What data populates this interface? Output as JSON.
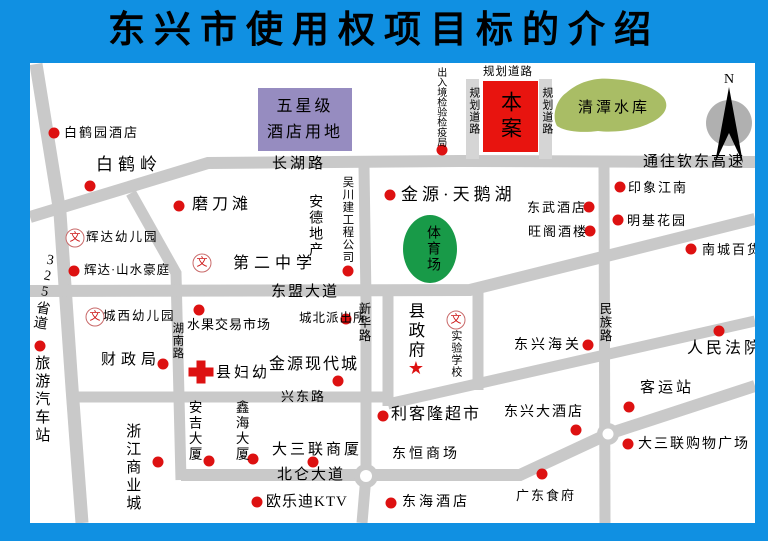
{
  "title": "东兴市使用权项目标的介绍",
  "map": {
    "colors": {
      "background": "#1090e2",
      "road": "#c9c9c9",
      "planned_road": "#d5d5d5",
      "marker": "#dd1111",
      "site_box": "#e8140f",
      "hotel_land_box": "#968cc0",
      "reservoir": "#a9bd65",
      "stadium": "#189a48",
      "compass_gray": "#b0b0b0"
    },
    "icons": {
      "school": "文",
      "star": "★"
    },
    "compass": {
      "label": "N"
    },
    "areas": {
      "hotel_land": {
        "line1": "五星级",
        "line2": "酒店用地"
      },
      "ben_an": {
        "text": "本案"
      },
      "reservoir": {
        "text": "清潭水库"
      },
      "stadium": {
        "text": "体育场"
      }
    },
    "labels": [
      {
        "name": "baiheyuan-hotel",
        "text": "白鹤园酒店",
        "type": "h",
        "x": 64,
        "y": 126,
        "size": 13,
        "ls": 2,
        "dot": [
          54,
          133
        ]
      },
      {
        "name": "baiheling",
        "text": "白鹤岭",
        "type": "h",
        "x": 96,
        "y": 156,
        "size": 17,
        "ls": 5,
        "dot": [
          90,
          186
        ]
      },
      {
        "name": "modaotan",
        "text": "磨刀滩",
        "type": "h",
        "x": 192,
        "y": 196,
        "size": 16,
        "ls": 4,
        "dot": [
          179,
          206
        ]
      },
      {
        "name": "huida-kindergarten",
        "text": "辉达幼儿园",
        "type": "h",
        "x": 86,
        "y": 231,
        "size": 12.5,
        "ls": 2,
        "wen": [
          75,
          238
        ]
      },
      {
        "name": "huida-shanshui-mansion",
        "text": "辉达·山水豪庭",
        "type": "h",
        "x": 84,
        "y": 264,
        "size": 12.5,
        "ls": 1,
        "dot": [
          74,
          271
        ]
      },
      {
        "name": "chengxi-kindergarten",
        "text": "城西幼儿园",
        "type": "h",
        "x": 103,
        "y": 310,
        "size": 12.5,
        "ls": 2,
        "wen": [
          95,
          317
        ]
      },
      {
        "name": "finance-bureau",
        "text": "财政局",
        "type": "h",
        "x": 101,
        "y": 352,
        "size": 15,
        "ls": 5,
        "dot": [
          163,
          364
        ]
      },
      {
        "name": "tourist-bus-station",
        "text": "旅游汽车站",
        "type": "v",
        "x": 33,
        "y": 355,
        "size": 15,
        "ls": 3,
        "dot": [
          40,
          346
        ]
      },
      {
        "name": "provincial-road-325",
        "text": "325省道",
        "type": "v",
        "x": 44,
        "y": 252,
        "size": 14,
        "ls": 1,
        "rot": 10
      },
      {
        "name": "zhejiang-commercial-city",
        "text": "浙江商业城",
        "type": "v",
        "x": 124,
        "y": 423,
        "size": 15,
        "ls": 3,
        "dot": [
          158,
          462
        ]
      },
      {
        "name": "changhu-road",
        "text": "长湖路",
        "type": "h",
        "x": 272,
        "y": 156,
        "size": 15,
        "ls": 3
      },
      {
        "name": "ande-property",
        "text": "安德地产",
        "type": "v",
        "x": 307,
        "y": 194,
        "size": 14,
        "ls": 2
      },
      {
        "name": "wuchuan-construction-co",
        "text": "吴川建工程公司",
        "type": "v",
        "x": 341,
        "y": 176,
        "size": 11.5,
        "ls": 1,
        "dot": [
          348,
          271
        ]
      },
      {
        "name": "no2-middle-school",
        "text": "第二中学",
        "type": "h",
        "x": 233,
        "y": 255,
        "size": 16,
        "ls": 5,
        "wen": [
          202,
          263
        ]
      },
      {
        "name": "dongmeng-avenue",
        "text": "东盟大道",
        "type": "h",
        "x": 271,
        "y": 284,
        "size": 15,
        "ls": 2
      },
      {
        "name": "hunan-road",
        "text": "湖南路",
        "type": "v",
        "x": 171,
        "y": 322,
        "size": 11.5,
        "ls": 1
      },
      {
        "name": "fruit-trading-market",
        "text": "水果交易市场",
        "type": "h",
        "x": 187,
        "y": 318,
        "size": 13,
        "ls": 1,
        "dot": [
          199,
          310
        ]
      },
      {
        "name": "county-maternity-hospital",
        "text": "县妇幼",
        "type": "h",
        "x": 216,
        "y": 365,
        "size": 15,
        "ls": 3,
        "cross": [
          201,
          372
        ]
      },
      {
        "name": "chengbei-police-station",
        "text": "城北派出所",
        "type": "h",
        "x": 299,
        "y": 312,
        "size": 12.5,
        "ls": 1,
        "dot": [
          346,
          319
        ]
      },
      {
        "name": "jinyuan-modern-city",
        "text": "金源现代城",
        "type": "h",
        "x": 269,
        "y": 356,
        "size": 16,
        "ls": 2,
        "dot": [
          338,
          381
        ]
      },
      {
        "name": "xinhua-road",
        "text": "新华路",
        "type": "v",
        "x": 356,
        "y": 302,
        "size": 12.5,
        "ls": 1
      },
      {
        "name": "xingdong-road",
        "text": "兴东路",
        "type": "h",
        "x": 281,
        "y": 390,
        "size": 13,
        "ls": 2
      },
      {
        "name": "anji-building",
        "text": "安吉大厦",
        "type": "v",
        "x": 186,
        "y": 400,
        "size": 13.5,
        "ls": 2,
        "dot": [
          209,
          461
        ]
      },
      {
        "name": "xinhai-building",
        "text": "鑫海大厦",
        "type": "v",
        "x": 233,
        "y": 400,
        "size": 13.5,
        "ls": 2,
        "dot": [
          253,
          459
        ]
      },
      {
        "name": "dasanlian-building",
        "text": "大三联商厦",
        "type": "h",
        "x": 272,
        "y": 442,
        "size": 15,
        "ls": 3,
        "dot": [
          313,
          462
        ]
      },
      {
        "name": "beilun-avenue",
        "text": "北仑大道",
        "type": "h",
        "x": 277,
        "y": 467,
        "size": 15,
        "ls": 2
      },
      {
        "name": "oulodi-ktv",
        "text": "欧乐迪KTV",
        "type": "h",
        "x": 266,
        "y": 494,
        "size": 15,
        "ls": 1,
        "dot": [
          257,
          502
        ]
      },
      {
        "name": "entry-exit-inspection-bureau",
        "text": "出入境检验检疫局",
        "type": "v",
        "x": 434,
        "y": 67,
        "size": 10,
        "ls": 0,
        "dot": [
          442,
          150
        ]
      },
      {
        "name": "planned-road-top",
        "text": "规划道路",
        "type": "h",
        "x": 483,
        "y": 66,
        "size": 11.5,
        "ls": 1
      },
      {
        "name": "planned-road-left",
        "text": "规划道路",
        "type": "v",
        "x": 467,
        "y": 87,
        "size": 11,
        "ls": 1
      },
      {
        "name": "planned-road-right",
        "text": "规划道路",
        "type": "v",
        "x": 540,
        "y": 87,
        "size": 11,
        "ls": 1
      },
      {
        "name": "to-qindong-expressway",
        "text": "通往钦东高速",
        "type": "h",
        "x": 643,
        "y": 154,
        "size": 15,
        "ls": 2
      },
      {
        "name": "jinyuan-swan-lake",
        "text": "金源·天鹅湖",
        "type": "h",
        "x": 401,
        "y": 186,
        "size": 17,
        "ls": 4,
        "dot": [
          390,
          195
        ]
      },
      {
        "name": "dongwu-hotel",
        "text": "东武酒店",
        "type": "h",
        "x": 527,
        "y": 201,
        "size": 13,
        "ls": 2,
        "dot": [
          589,
          207
        ]
      },
      {
        "name": "wangge-restaurant",
        "text": "旺阁酒楼",
        "type": "h",
        "x": 528,
        "y": 225,
        "size": 13,
        "ls": 2,
        "dot": [
          590,
          231
        ]
      },
      {
        "name": "yinxiang-jiangnan",
        "text": "印象江南",
        "type": "h",
        "x": 628,
        "y": 181,
        "size": 13,
        "ls": 2,
        "dot": [
          620,
          187
        ]
      },
      {
        "name": "mingji-garden",
        "text": "明基花园",
        "type": "h",
        "x": 627,
        "y": 214,
        "size": 13,
        "ls": 2,
        "dot": [
          618,
          220
        ]
      },
      {
        "name": "nancheng-department-store",
        "text": "南城百货",
        "type": "h",
        "x": 702,
        "y": 243,
        "size": 13,
        "ls": 2,
        "dot": [
          691,
          249
        ]
      },
      {
        "name": "county-government",
        "text": "县政府",
        "type": "v",
        "x": 406,
        "y": 302,
        "size": 16.5,
        "ls": 3,
        "star": [
          416,
          369
        ]
      },
      {
        "name": "experimental-school",
        "text": "实验学校",
        "type": "v",
        "x": 449,
        "y": 330,
        "size": 11,
        "ls": 1,
        "wen": [
          456,
          320
        ]
      },
      {
        "name": "dongxing-customs",
        "text": "东兴海关",
        "type": "h",
        "x": 514,
        "y": 338,
        "size": 14,
        "ls": 3,
        "dot": [
          588,
          345
        ]
      },
      {
        "name": "minzu-road",
        "text": "民族路",
        "type": "v",
        "x": 597,
        "y": 302,
        "size": 12.5,
        "ls": 1
      },
      {
        "name": "people-court",
        "text": "人民法院",
        "type": "h",
        "x": 687,
        "y": 340,
        "size": 16,
        "ls": 3,
        "dot": [
          719,
          331
        ]
      },
      {
        "name": "likelong-supermarket",
        "text": "利客隆超市",
        "type": "h",
        "x": 391,
        "y": 406,
        "size": 16,
        "ls": 2,
        "dot": [
          383,
          416
        ]
      },
      {
        "name": "dongheng-mall",
        "text": "东恒商场",
        "type": "h",
        "x": 392,
        "y": 447,
        "size": 14,
        "ls": 3
      },
      {
        "name": "donghai-hotel",
        "text": "东海酒店",
        "type": "h",
        "x": 402,
        "y": 495,
        "size": 14,
        "ls": 3,
        "dot": [
          391,
          503
        ]
      },
      {
        "name": "dongxing-grand-hotel",
        "text": "东兴大酒店",
        "type": "h",
        "x": 504,
        "y": 405,
        "size": 14,
        "ls": 2,
        "dot": [
          576,
          430
        ]
      },
      {
        "name": "passenger-station",
        "text": "客运站",
        "type": "h",
        "x": 640,
        "y": 380,
        "size": 15,
        "ls": 3,
        "dot": [
          629,
          407
        ]
      },
      {
        "name": "dasanlian-shopping-plaza",
        "text": "大三联购物广场",
        "type": "h",
        "x": 638,
        "y": 437,
        "size": 14,
        "ls": 2,
        "dot": [
          628,
          444
        ]
      },
      {
        "name": "guangdong-restaurant",
        "text": "广东食府",
        "type": "h",
        "x": 516,
        "y": 489,
        "size": 13,
        "ls": 2,
        "dot": [
          542,
          474
        ]
      }
    ]
  }
}
